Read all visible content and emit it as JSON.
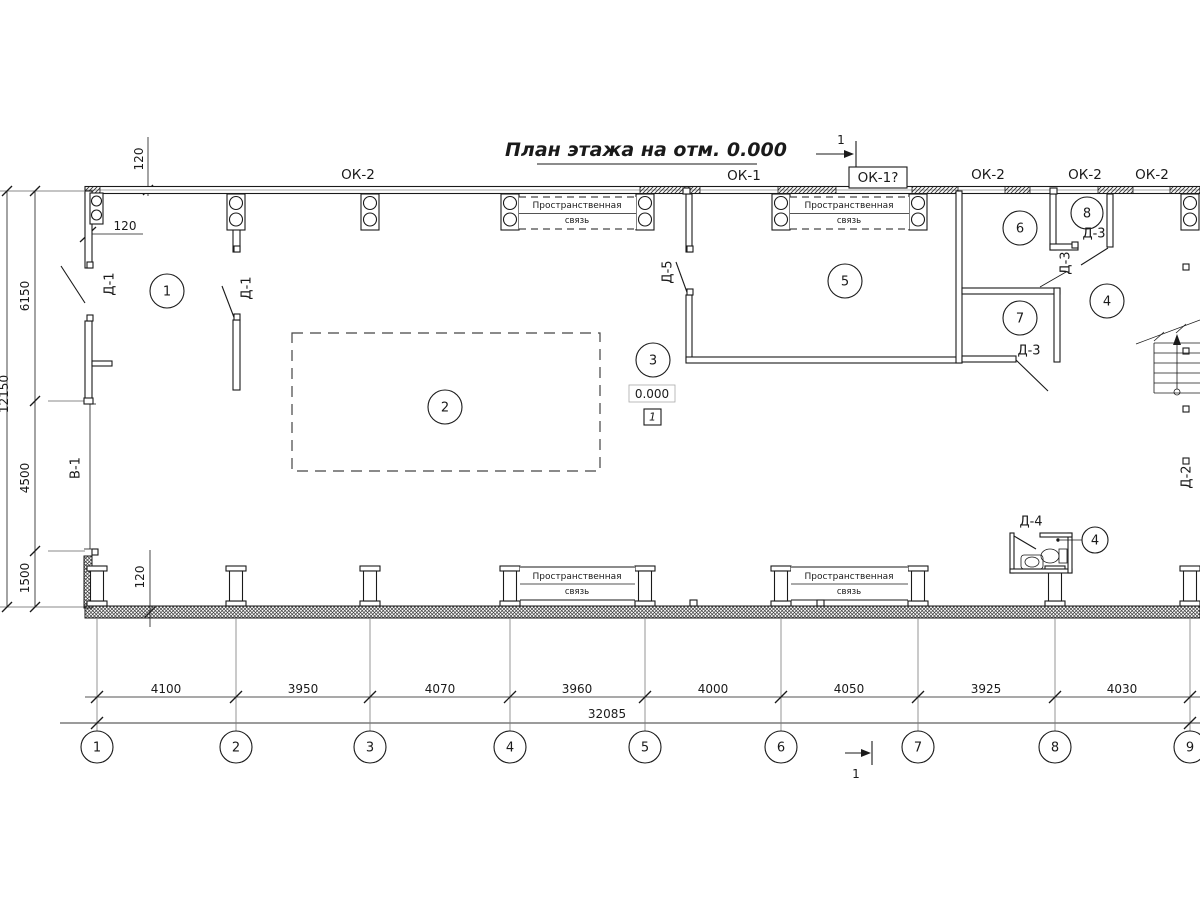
{
  "title": "План этажа на отм. 0.000",
  "top_labels": {
    "ok2_a": "ОК-2",
    "ok1": "ОК-1",
    "ok1_boxed": "ОК-1?",
    "ok2_b": "ОК-2",
    "ok2_c": "ОК-2",
    "ok2_d": "ОК-2"
  },
  "rooms": {
    "r1": "1",
    "r2": "2",
    "r3": "3",
    "r4": "4",
    "r5": "5",
    "r6": "6",
    "r7": "7",
    "r8": "8",
    "r4_wc": "4"
  },
  "doors": {
    "d1_left": "Д-1",
    "d1_mid": "Д-1",
    "d5": "Д-5",
    "d3_room8": "Д-3",
    "d3_rot": "Д-3",
    "d3_room7": "Д-3",
    "d4": "Д-4",
    "d2": "Д-2",
    "gate": "В-1"
  },
  "brace": {
    "line1": "Пространственная",
    "line2": "связь"
  },
  "level": {
    "value": "0.000",
    "flag": "1"
  },
  "section": {
    "num": "1"
  },
  "dims": {
    "left": {
      "d120_top": "120",
      "d120_wall": "120",
      "d6150": "6150",
      "d4500": "4500",
      "d1500": "1500",
      "d12150": "12150",
      "d120_bottom": "120"
    },
    "bottom": [
      "4100",
      "3950",
      "4070",
      "3960",
      "4000",
      "4050",
      "3925",
      "4030"
    ],
    "total": "32085"
  },
  "axes": [
    "1",
    "2",
    "3",
    "4",
    "5",
    "6",
    "7",
    "8",
    "9"
  ],
  "colors": {
    "line": "#1a1a1a",
    "gray": "#8a8a8a"
  }
}
